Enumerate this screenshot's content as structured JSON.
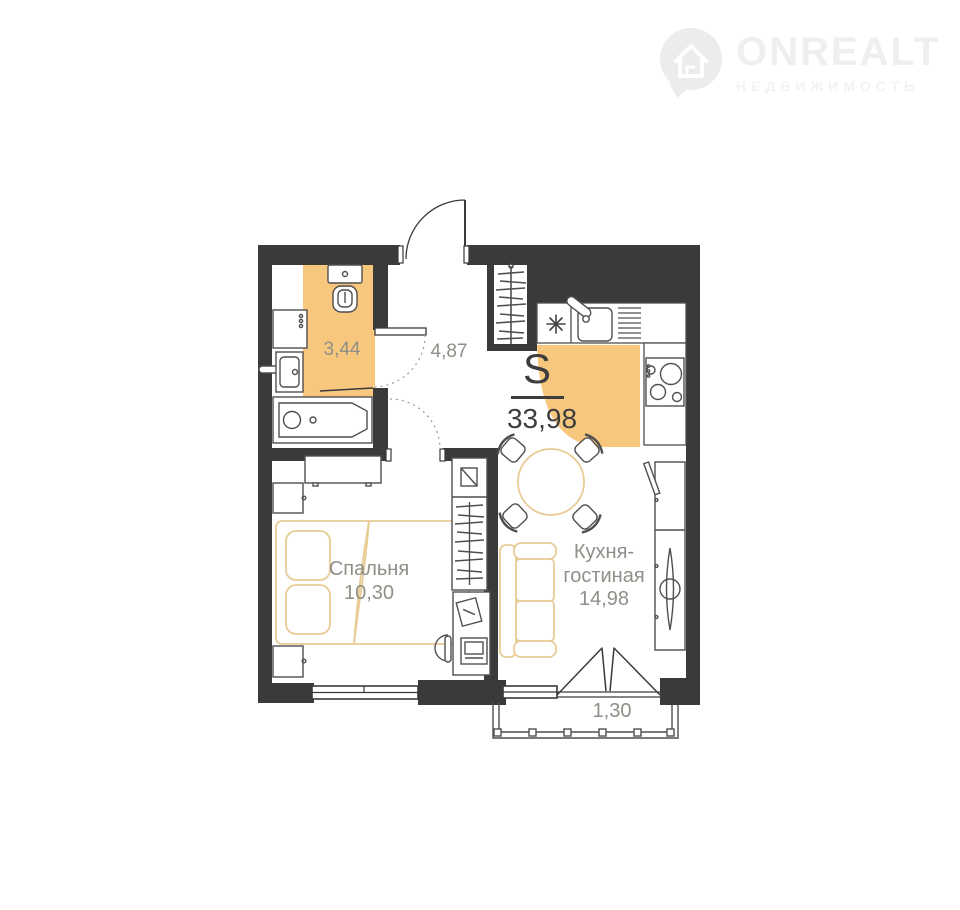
{
  "logo": {
    "brand": "ONREALT",
    "subtitle": "НЕДВИЖИМОСТЬ"
  },
  "plan": {
    "total": {
      "symbol": "S",
      "area": "33,98"
    },
    "rooms": {
      "bathroom": {
        "area": "3,44"
      },
      "hallway": {
        "area": "4,87"
      },
      "bedroom": {
        "name": "Спальня",
        "area": "10,30"
      },
      "kitchen_living": {
        "name_line1": "Кухня-",
        "name_line2": "гостиная",
        "area": "14,98"
      },
      "balcony": {
        "area": "1,30"
      }
    },
    "colors": {
      "wall": "#3a3a3a",
      "zone_highlight": "#f8c77e",
      "accent_furniture": "#e9cb96",
      "room_label": "#8f8f88",
      "total_label": "#3d3d3d"
    }
  }
}
